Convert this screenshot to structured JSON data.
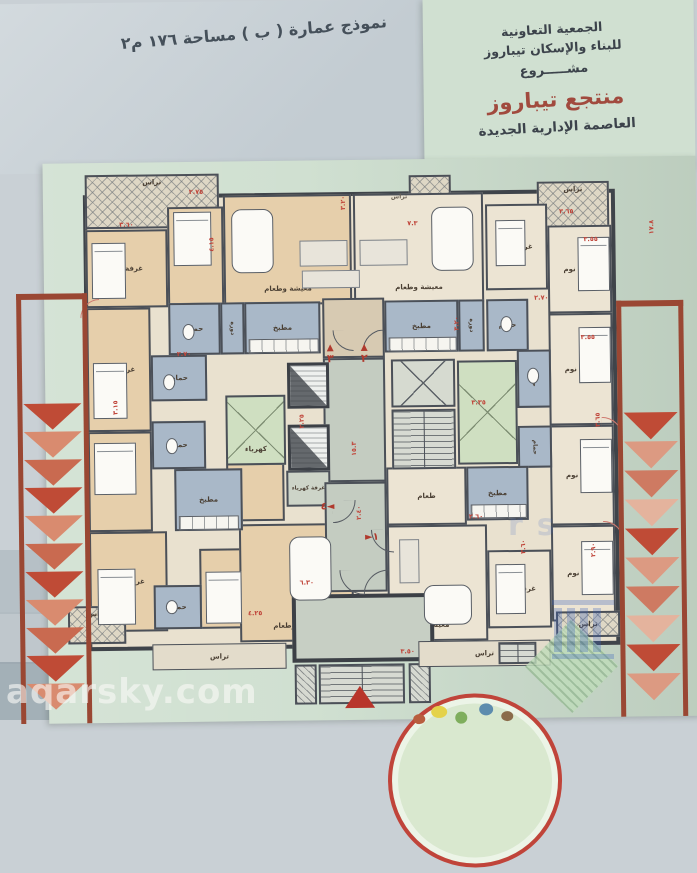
{
  "header": {
    "model_title": "نموذج عمارة ( ب ) مساحة ١٧٦ م٢",
    "association_line1": "الجمعية التعاونية",
    "association_line2": "للبناء والإسكان تيباروز",
    "project_word": "مشـــــروع",
    "project_name": "منتجع تيباروز",
    "location_line": "العاصمة الإدارية الجديدة"
  },
  "plan": {
    "room_labels": {
      "bedroom": "غرفة نوم",
      "living_dining": "معيشة وطعام",
      "living": "معيشة",
      "dining": "طعام",
      "kitchen": "مطبخ",
      "bathroom": "حمام",
      "toilet": "دورة",
      "terrace": "تراس",
      "electricity_room": "غرفة كهرباء",
      "electricity": "كهرباء"
    },
    "unit_numbers": {
      "u1": "١",
      "u2": "٢",
      "u3": "٣",
      "u4": "٤"
    },
    "dims": [
      "٢.٧٥",
      "٣.٦٠",
      "٣.٢٠",
      "٧.٣",
      "٣.٦٥",
      "٣.٥٥",
      "٢.٧٠",
      "٣.٥٥",
      "٣.٣٥",
      "١٥.٣",
      "٢.٢٥",
      "٣.٦٥",
      "٢.٦٠",
      "٣.٦٠",
      "٢.٩٠",
      "٤.٢٥",
      "٣.١٥",
      "٢.٧٠",
      "٣.٥٠",
      "٦.٣٠",
      "١٧.٨",
      "٤.١٥",
      "٣.٢٠",
      "٢.٤٠"
    ]
  },
  "watermark": {
    "site": "aqarsky.com",
    "fragment": "rs"
  },
  "colors": {
    "accent_red": "#b03a2e",
    "dim_red": "#c0453a",
    "wall": "#42474d",
    "peach": "#e6cfab",
    "blue_room": "#a9b8c8",
    "green_paper": "#d0e0d1",
    "maroon_title": "#a14a3e"
  }
}
